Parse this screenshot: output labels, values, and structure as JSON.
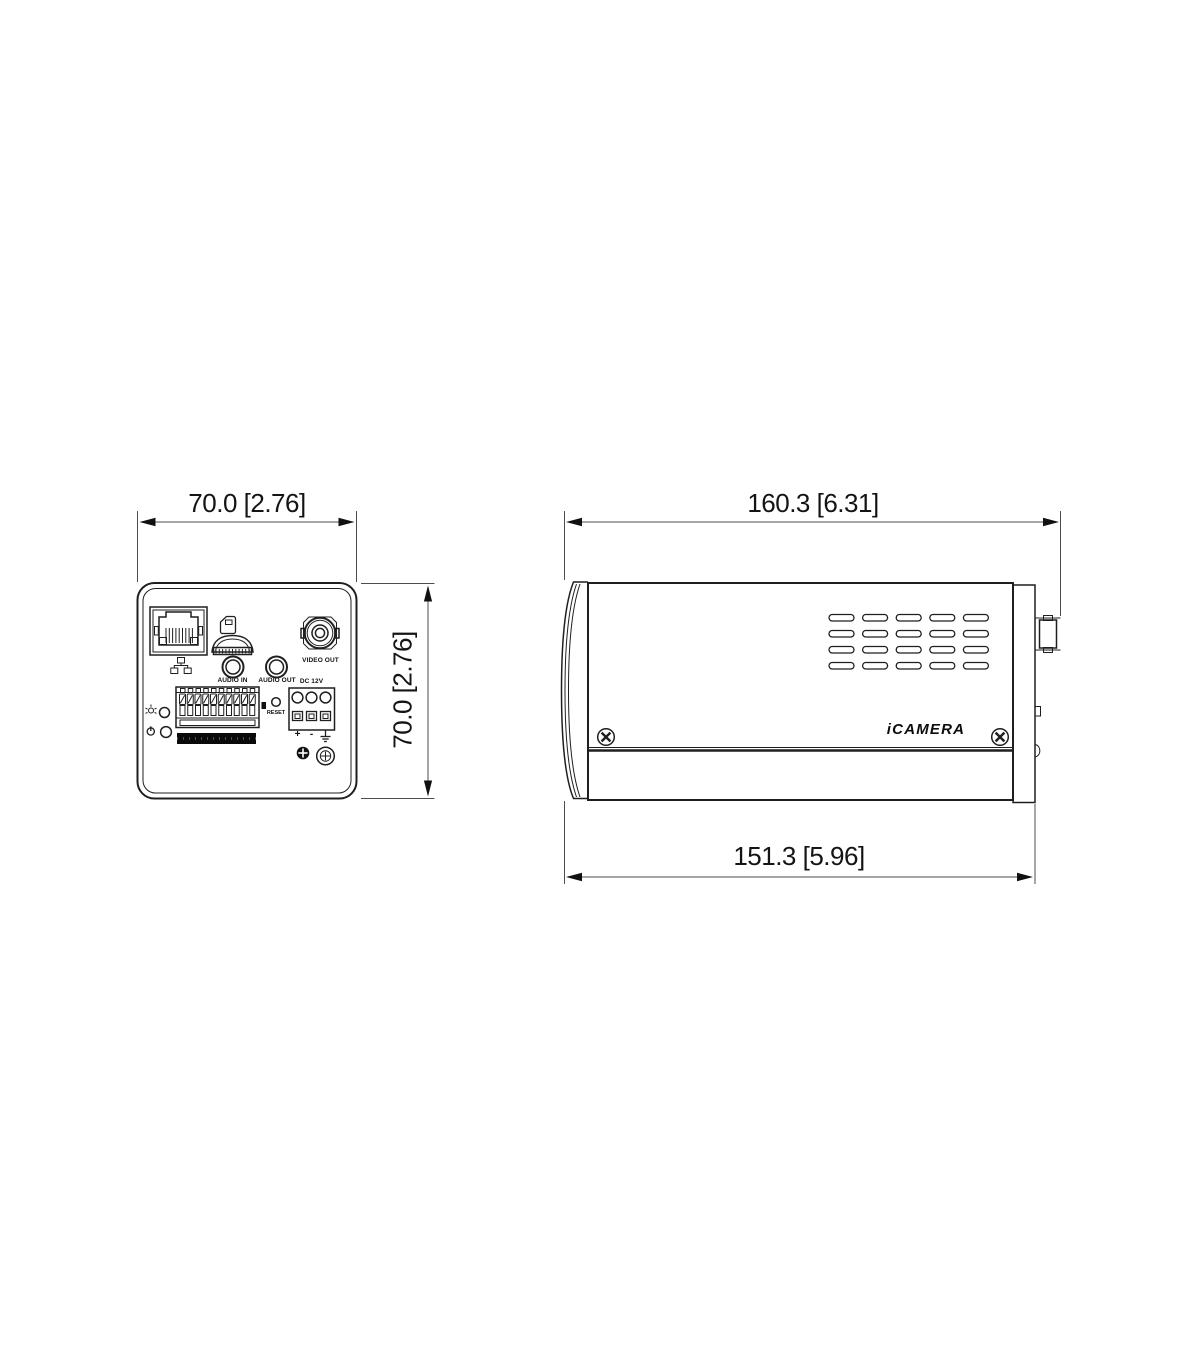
{
  "drawing": {
    "front_view": {
      "width_dim": "70.0 [2.76]",
      "height_dim": "70.0 [2.76]",
      "labels": {
        "audio_in": "AUDIO IN",
        "audio_out": "AUDIO OUT",
        "video_out": "VIDEO OUT",
        "reset": "RESET",
        "dc_power": "DC 12V",
        "plus": "+",
        "minus": "-"
      }
    },
    "side_view": {
      "length_dim": "160.3 [6.31]",
      "base_length_dim": "151.3 [5.96]",
      "brand": "iCAMERA"
    },
    "colors": {
      "line": "#1f1f1f",
      "dimension": "#4c4c4c",
      "background": "#ffffff"
    }
  }
}
